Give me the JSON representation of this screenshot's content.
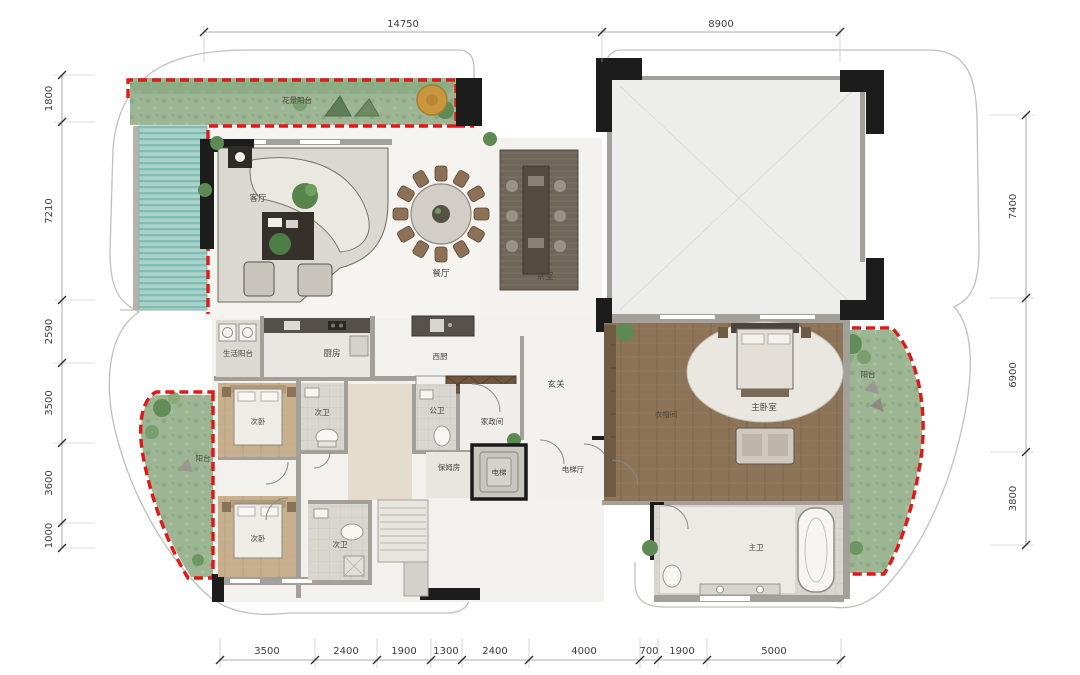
{
  "drawing": {
    "type": "residential-floor-plan",
    "colors": {
      "boundary_red": "#e01818",
      "garden_green": "#9cb592",
      "pool_teal": "#8fc6bd",
      "wood_dark": "#8d7458",
      "wood_light": "#c9b190",
      "wall_black": "#1c1c1c",
      "marble": "#f4f3f0"
    }
  },
  "rooms": {
    "garden_balcony": "花景阳台",
    "living_room": "客厅",
    "dining_room": "餐厅",
    "tea_room": "茶室",
    "service_balcony": "生活阳台",
    "kitchen": "厨房",
    "west_kitchen": "西厨",
    "foyer": "玄关",
    "bedroom_a": "次卧",
    "bath_a": "次卫",
    "public_bath": "公卫",
    "housekeeping": "家政间",
    "nanny_room": "保姆房",
    "elevator": "电梯",
    "elevator_hall": "电梯厅",
    "cloakroom": "衣帽间",
    "master_bedroom": "主卧室",
    "master_bath": "主卫",
    "balcony_left": "阳台",
    "balcony_right": "阳台",
    "bedroom_b": "次卧",
    "bath_b": "次卫"
  },
  "dimensions": {
    "top": [
      "14750",
      "8900"
    ],
    "left": [
      "1800",
      "7210",
      "2590",
      "3500",
      "3600",
      "1000"
    ],
    "right": [
      "7400",
      "6900",
      "3800"
    ],
    "bottom": [
      "3500",
      "2400",
      "1900",
      "1300",
      "2400",
      "4000",
      "700",
      "1900",
      "5000"
    ]
  }
}
